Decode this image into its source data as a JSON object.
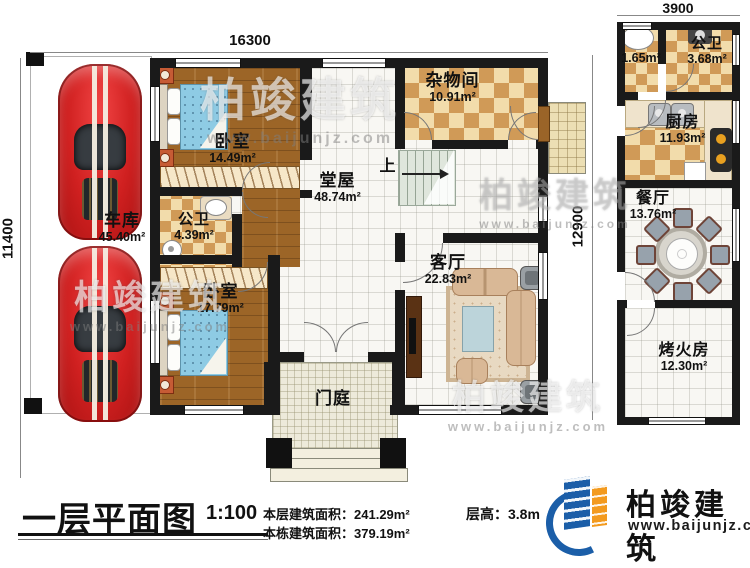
{
  "plan": {
    "dimensions": {
      "top_main": "16300",
      "top_right": "3900",
      "left": "11400",
      "right_mid": "12900"
    },
    "stairs_up": "上",
    "rooms": {
      "garage": {
        "name": "车库",
        "area": "45.40m²"
      },
      "bedroom1": {
        "name": "卧室",
        "area": "14.49m²"
      },
      "bath1": {
        "name": "公卫",
        "area": "4.39m²"
      },
      "bedroom2": {
        "name": "卧室",
        "area": "17.79m²"
      },
      "hall": {
        "name": "堂屋",
        "area": "48.74m²"
      },
      "storage": {
        "name": "杂物间",
        "area": "10.91m²"
      },
      "living": {
        "name": "客厅",
        "area": "22.83m²"
      },
      "porch": {
        "name": "门庭"
      },
      "washroom": {
        "area": "1.65m²"
      },
      "bath2": {
        "name": "公卫",
        "area": "3.68m²"
      },
      "kitchen": {
        "name": "厨房",
        "area": "11.93m²"
      },
      "dining": {
        "name": "餐厅",
        "area": "13.76m²"
      },
      "fire": {
        "name": "烤火房",
        "area": "12.30m²"
      }
    }
  },
  "footer": {
    "title": "一层平面图",
    "scale": "1:100",
    "floor_area_label": "本层建筑面积：",
    "floor_area_value": "241.29m²",
    "total_area_label": "本栋建筑面积：",
    "total_area_value": "379.19m²",
    "height_label": "层高：",
    "height_value": "3.8m"
  },
  "logo": {
    "name": "柏竣建筑",
    "url": "www.baijunjz.com"
  },
  "watermark": {
    "text": "柏竣建筑",
    "url": "www.baijunjz.com"
  },
  "colors": {
    "brand_blue": "#1b5ea8",
    "brand_orange": "#f39a1e",
    "wall": "#1a1a1a"
  }
}
